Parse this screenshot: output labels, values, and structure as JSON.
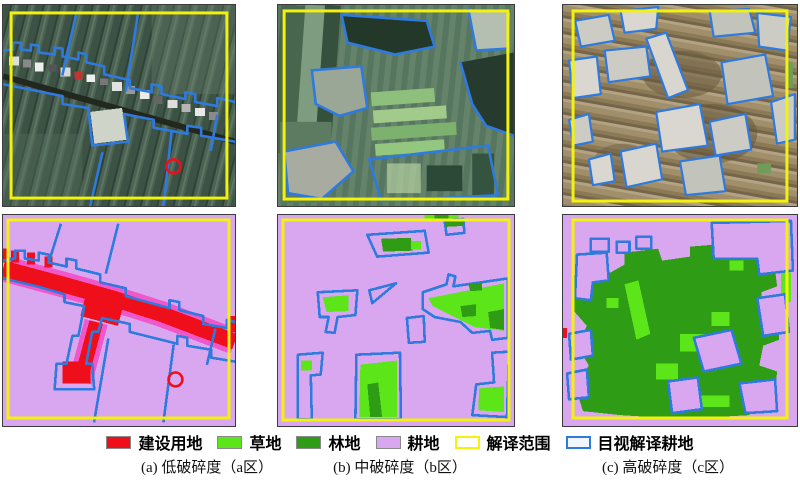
{
  "figure_title": "耕地破碎度分区解译对比图",
  "legend": {
    "items": [
      {
        "label": "建设用地",
        "color": "#ee0f1a",
        "style": "fill"
      },
      {
        "label": "草地",
        "color": "#5ce619",
        "style": "fill"
      },
      {
        "label": "林地",
        "color": "#2f9c15",
        "style": "fill"
      },
      {
        "label": "耕地",
        "color": "#d9a7ef",
        "style": "fill"
      },
      {
        "label": "解译范围",
        "color": "#f2f20c",
        "style": "outline",
        "fill": "#ffffff"
      },
      {
        "label": "目视解译耕地",
        "color": "#2e7ade",
        "style": "outline",
        "fill": "#f2f7ff"
      }
    ]
  },
  "captions": {
    "a": "(a) 低破碎度（a区）",
    "b": "(b) 中破碎度（b区）",
    "c": "(c) 高破碎度（c区）"
  },
  "panels": [
    {
      "id": "a-top",
      "desc": "a区遥感影像（低破碎度）"
    },
    {
      "id": "b-top",
      "desc": "b区遥感影像（中破碎度）"
    },
    {
      "id": "c-top",
      "desc": "c区遥感影像（高破碎度）"
    },
    {
      "id": "a-bottom",
      "desc": "a区解译分类图"
    },
    {
      "id": "b-bottom",
      "desc": "b区解译分类图"
    },
    {
      "id": "c-bottom",
      "desc": "c区解译分类图"
    }
  ],
  "colors": {
    "red": "#ee0f1a",
    "pink": "#ef57cb",
    "lightgreen": "#5ce619",
    "darkgreen": "#2f9c15",
    "purple": "#d9a7ef",
    "yellow": "#f2f20c",
    "blue": "#2e7ade"
  }
}
